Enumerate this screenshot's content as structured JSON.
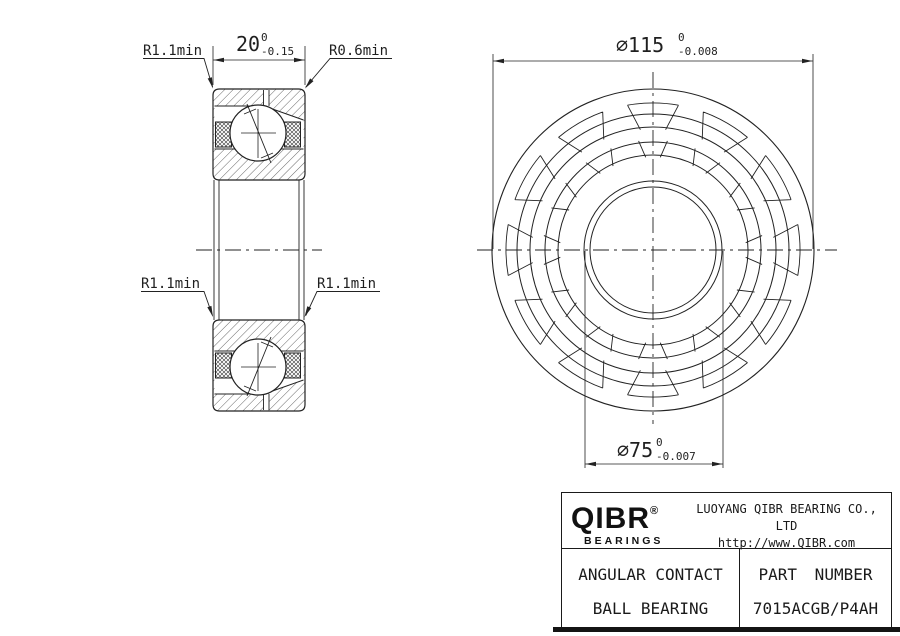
{
  "dimensions": {
    "width": {
      "value": "20",
      "tol_upper": "0",
      "tol_lower": "-0.15"
    },
    "outer_diameter": {
      "value": "⌀115",
      "tol_upper": "0",
      "tol_lower": "-0.008"
    },
    "bore_diameter": {
      "value": "⌀75",
      "tol_upper": "0",
      "tol_lower": "-0.007"
    },
    "radius_top_left": "R1.1min",
    "radius_top_right": "R0.6min",
    "radius_mid_left": "R1.1min",
    "radius_mid_right": "R1.1min"
  },
  "title_block": {
    "logo": {
      "name": "QIBR",
      "registered": "®",
      "tagline": "BEARINGS"
    },
    "company": "LUOYANG QIBR BEARING CO., LTD",
    "website": "http://www.QIBR.com",
    "product": {
      "line1": "ANGULAR CONTACT",
      "line2": "BALL BEARING"
    },
    "part": {
      "label": "PART NUMBER",
      "number": "7015ACGB/P4AH"
    }
  }
}
